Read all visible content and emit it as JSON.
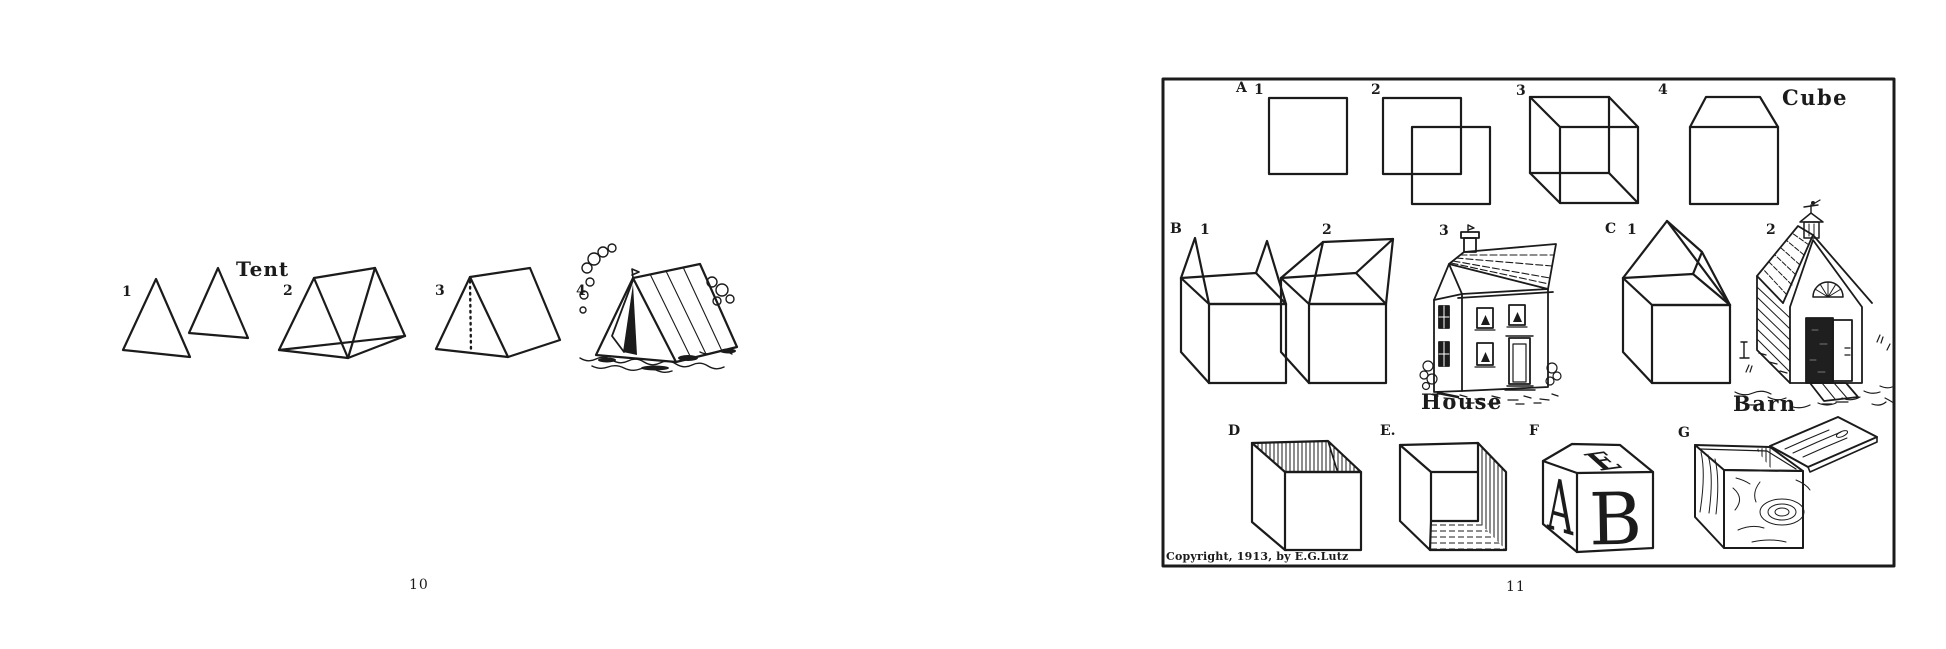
{
  "left_page": {
    "caption": "Tent",
    "step_numbers": [
      "1",
      "2",
      "3",
      "4"
    ],
    "page_number": "10"
  },
  "right_page": {
    "row_a": {
      "letter": "A",
      "step_numbers": [
        "1",
        "2",
        "3",
        "4"
      ],
      "caption": "Cube"
    },
    "row_b": {
      "letter": "B",
      "step_numbers": [
        "1",
        "2",
        "3"
      ],
      "caption": "House"
    },
    "row_c": {
      "letter": "C",
      "step_numbers": [
        "1",
        "2"
      ],
      "caption": "Barn"
    },
    "bottom_row": {
      "labels": [
        "D",
        "E.",
        "F",
        "G"
      ]
    },
    "block_letters": {
      "top": "E",
      "left_side": "A",
      "front": "B"
    },
    "copyright_notice": "Copyright, 1913, by E.G.Lutz",
    "page_number": "11"
  },
  "colors": {
    "ink": "#1b1b1b",
    "paper": "#ffffff"
  }
}
